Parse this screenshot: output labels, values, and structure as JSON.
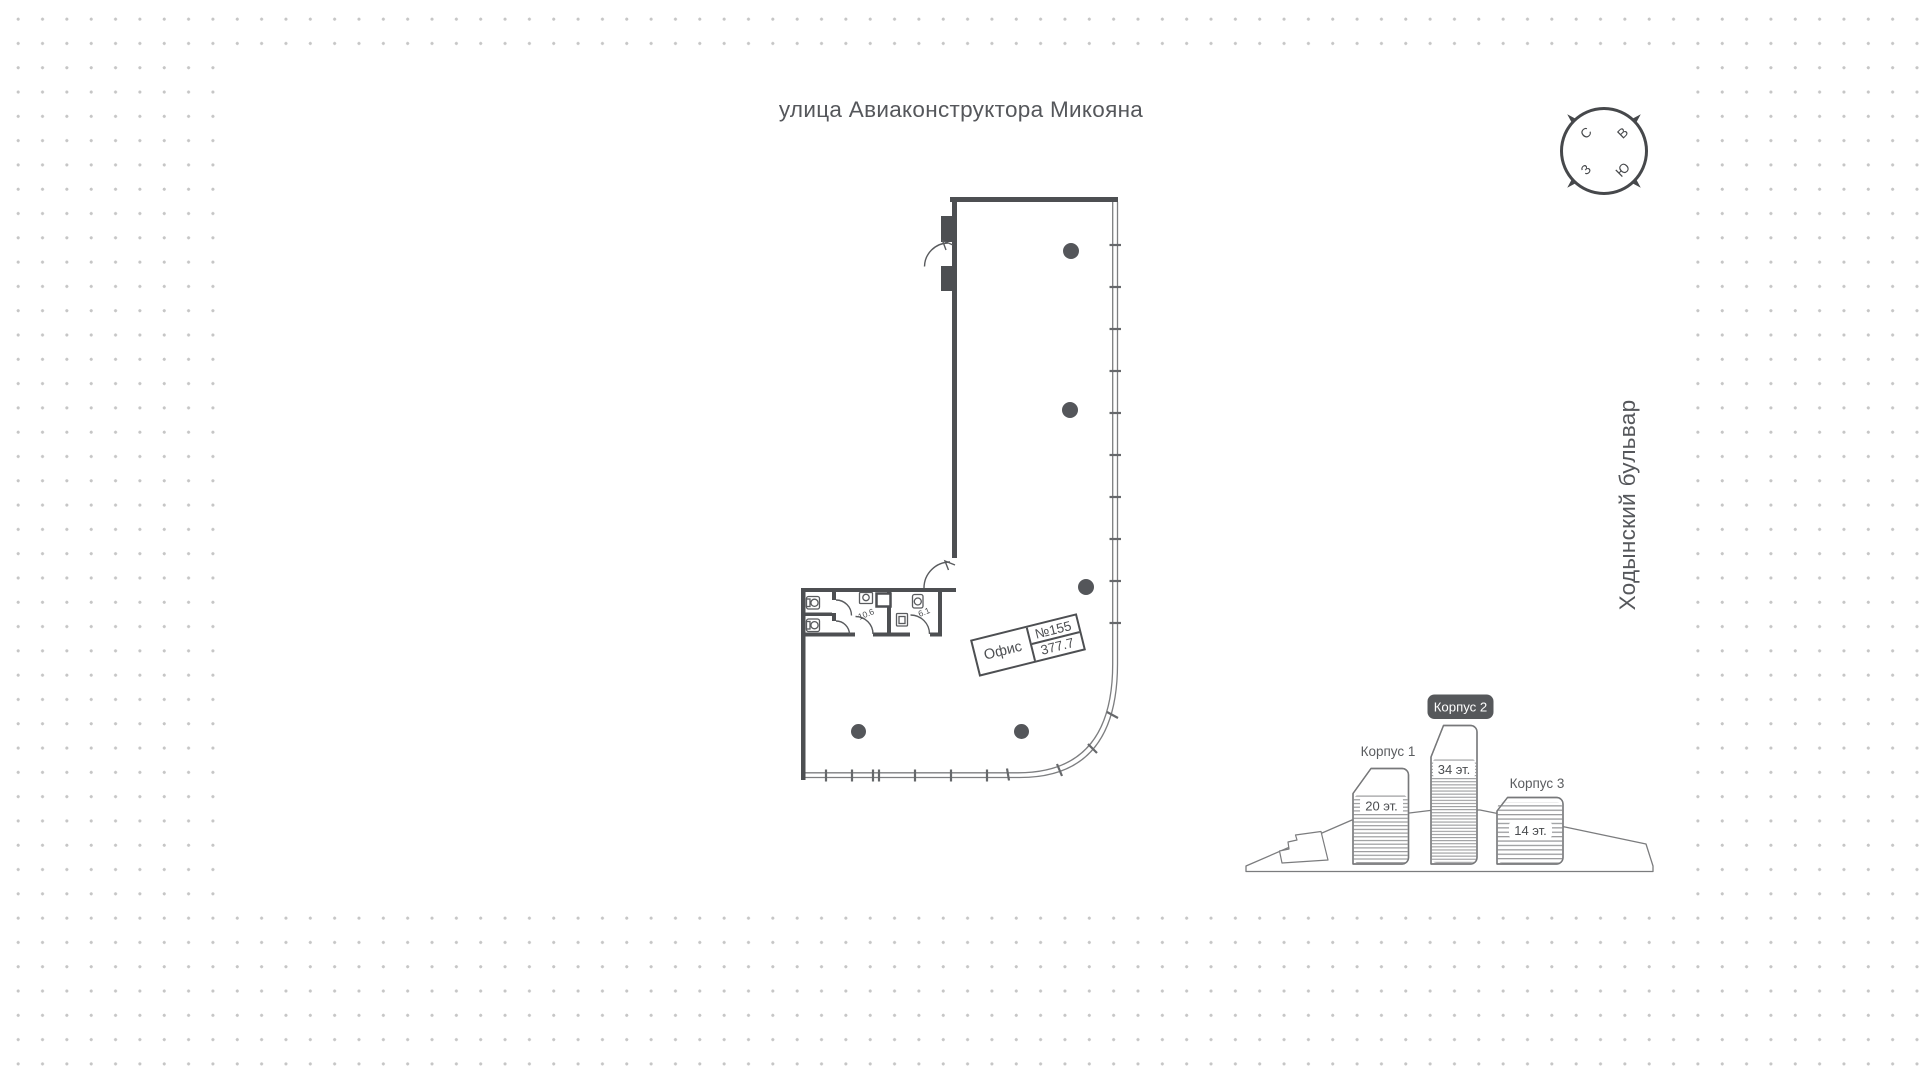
{
  "map": {
    "street_top": "улица Авиаконструктора Микояна",
    "street_right": "Ходынский бульвар"
  },
  "compass": {
    "n": "С",
    "e": "В",
    "s": "Ю",
    "w": "З"
  },
  "unit": {
    "label": "Офис",
    "number": "№155",
    "area": "377.7"
  },
  "plan_rooms": {
    "wc_large": "10.6",
    "wc_small": "6.1"
  },
  "buildings": [
    {
      "name": "Корпус 1",
      "floors": "20 эт.",
      "highlighted": false
    },
    {
      "name": "Корпус 2",
      "floors": "34 эт.",
      "highlighted": true
    },
    {
      "name": "Корпус 3",
      "floors": "14 эт.",
      "highlighted": false
    }
  ],
  "colors": {
    "wall": "#4d4f52",
    "window_line": "#7d7e80",
    "badge": "#56585b",
    "text": "#55575b",
    "dot": "#c6c6c6"
  }
}
